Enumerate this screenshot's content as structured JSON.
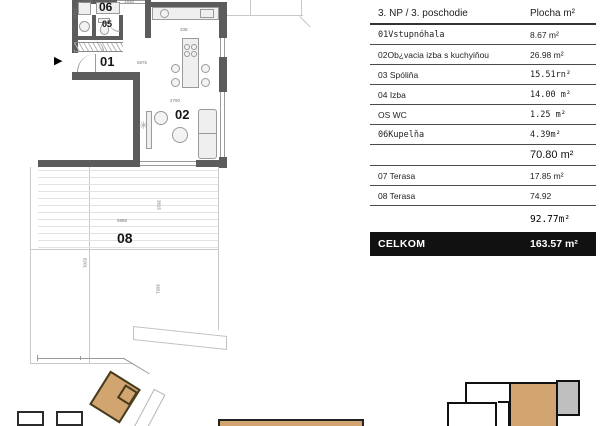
{
  "table": {
    "header": {
      "name_col": "3. NP / 3. poschodie",
      "area_col": "Plocha m²"
    },
    "rows": [
      {
        "label": "01Vstupnóhala",
        "value": "8.67 m²"
      },
      {
        "label": "02Ob¿vacia izba s kuchyiňou",
        "value": "26.98 m²"
      },
      {
        "label": "03 Spóliňa",
        "value": "15.51rn²"
      },
      {
        "label": "04 Izba",
        "value": "14.00 m²"
      },
      {
        "label": "OS WC",
        "value": "1.25 m²"
      },
      {
        "label": "06Kupelňa",
        "value": "4.39m²"
      },
      {
        "label": "",
        "value": "70.80 m²"
      },
      {
        "label": "07 Terasa",
        "value": "17.85 m²"
      },
      {
        "label": "08 Terasa",
        "value": "74.92"
      },
      {
        "label": "",
        "value": "92.77m²"
      }
    ],
    "total": {
      "label": "CELKOM",
      "value": "163.57 m²"
    }
  },
  "floorplan": {
    "rooms": {
      "hall": "01",
      "living": "02",
      "wc": "05",
      "bath": "06",
      "terrace": "08"
    },
    "dimensions": {
      "d1": "2188",
      "d2": "1930",
      "d3": "2414",
      "d4": "338",
      "d5": "6875",
      "d6": "2790",
      "d7": "5886",
      "d8": "3815",
      "d9": "8201",
      "d10": "3651"
    }
  },
  "icons": {
    "entrance_arrow": "▶",
    "plant": "✳"
  },
  "colors": {
    "wall": "#5c5c5c",
    "unit_highlight": "#d2a46f",
    "section_gray": "#bfbfbf",
    "total_bar": "#111111"
  }
}
